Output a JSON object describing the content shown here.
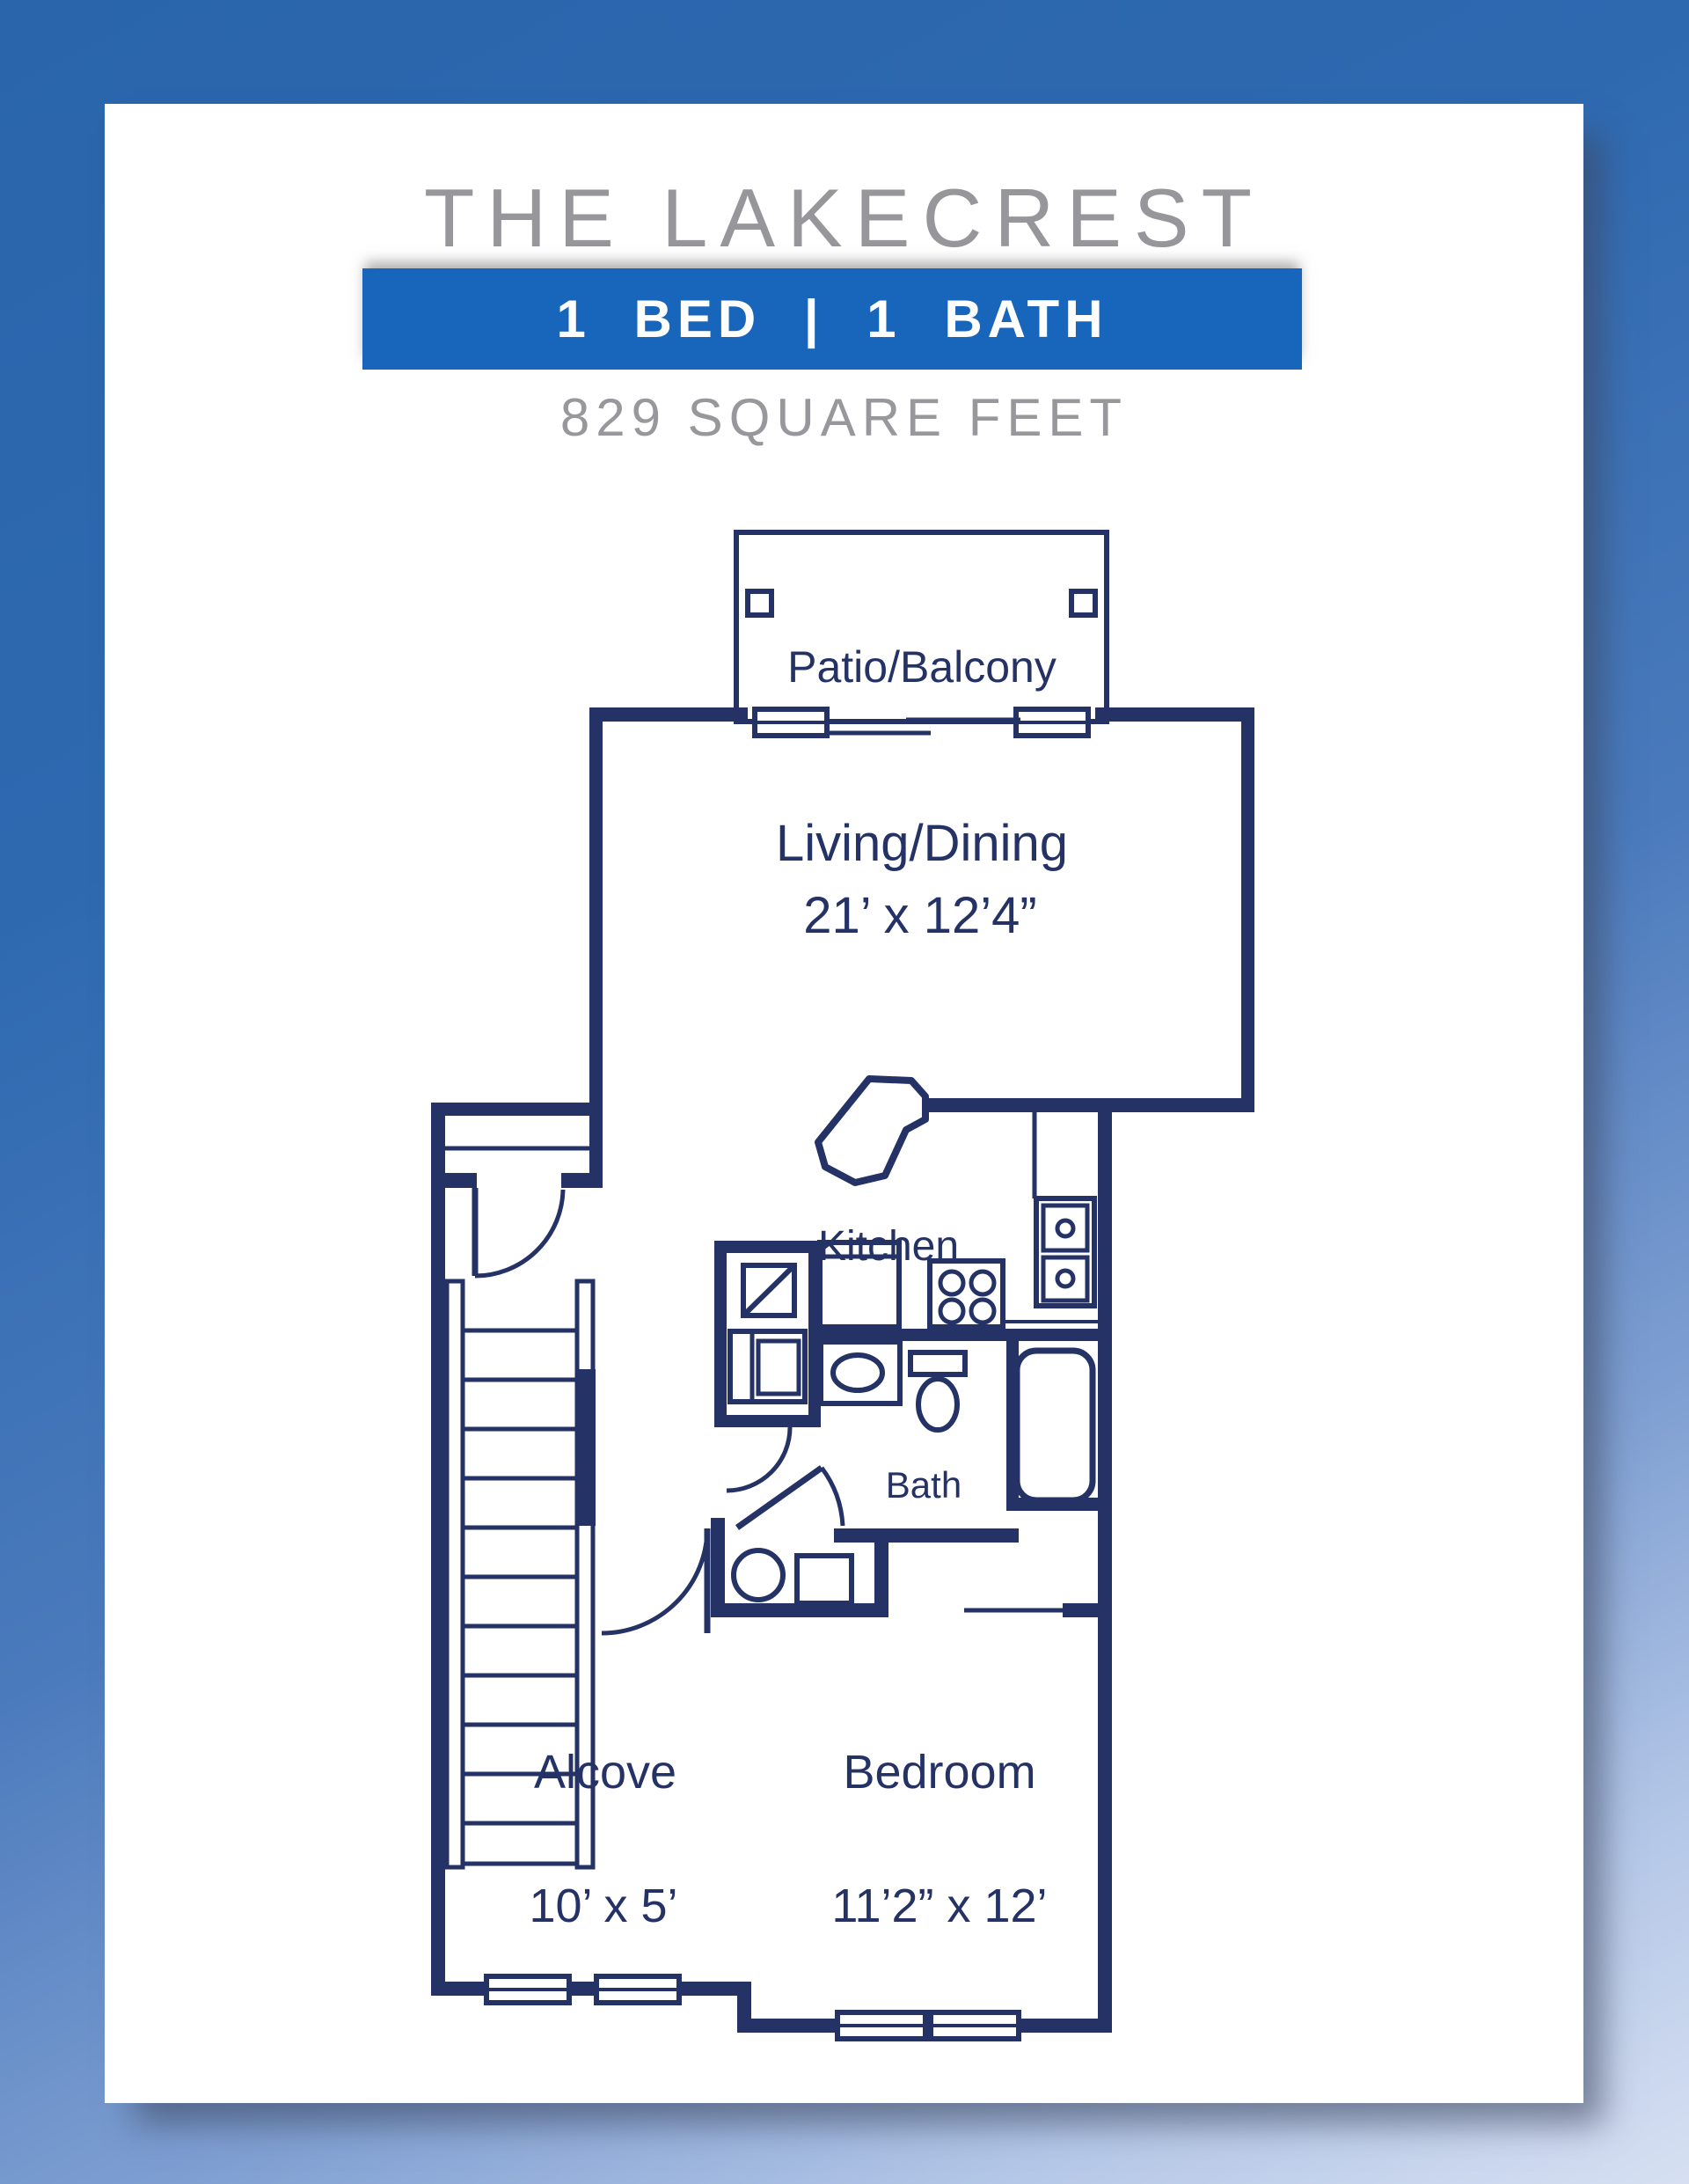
{
  "header": {
    "title": "THE LAKECREST",
    "banner_label": "1 BED | 1 BATH",
    "square_feet": "829 SQUARE FEET"
  },
  "rooms": {
    "patio": {
      "name": "Patio/Balcony"
    },
    "living": {
      "name": "Living/Dining",
      "dims": "21’ x 12’4”"
    },
    "kitchen": {
      "name": "Kitchen"
    },
    "bath": {
      "name": "Bath"
    },
    "alcove": {
      "name": "Alcove",
      "dims": "10’ x 5’"
    },
    "bedroom": {
      "name": "Bedroom",
      "dims": "11’2” x 12’"
    }
  },
  "colors": {
    "plan_navy": "#243265",
    "banner_blue": "#1766bb",
    "title_gray": "#97979b",
    "background_top": "#2a65ac",
    "background_bottom": "#d7e0f2",
    "card_white": "#ffffff"
  }
}
